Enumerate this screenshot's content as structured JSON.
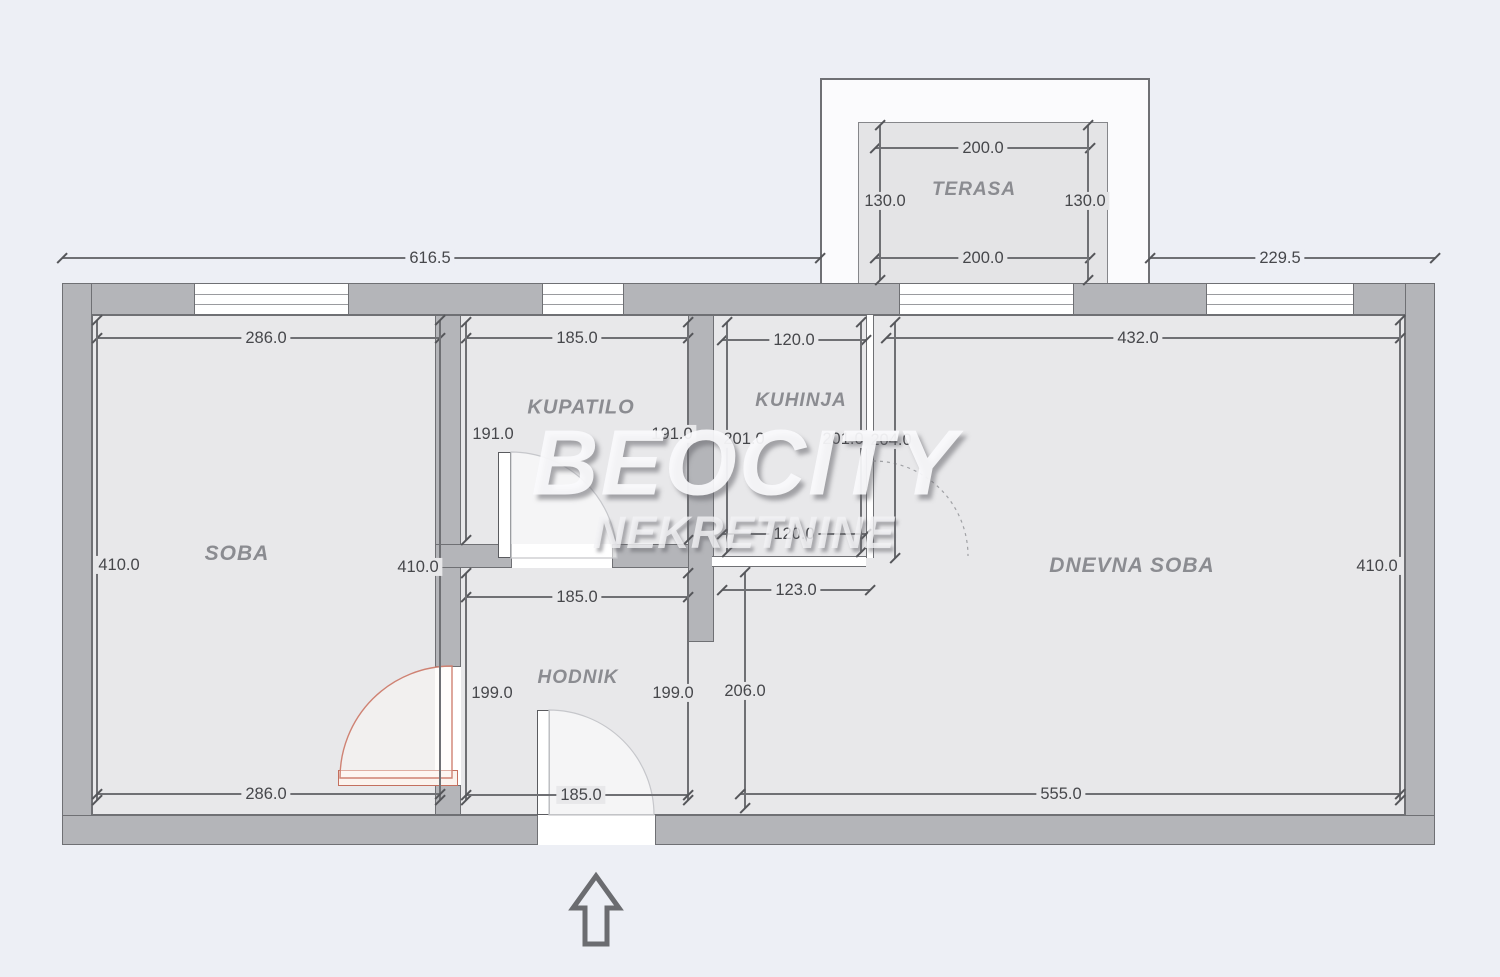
{
  "watermark": {
    "line1": "BEOCITY",
    "line2": "NEKRETNINE"
  },
  "colors": {
    "page": "#edeff5",
    "room": "#e8e8ea",
    "terrace": "#e4e4e6",
    "wall_fill": "#b4b5b9",
    "wall_border": "#6f7074",
    "dim": "#55565a",
    "red_door": "#c4705f",
    "room_label": "#8b8c91"
  },
  "rooms": [
    {
      "name": "SOBA",
      "x": 237,
      "y": 554,
      "size": 21
    },
    {
      "name": "KUPATILO",
      "x": 581,
      "y": 408,
      "size": 20
    },
    {
      "name": "KUHINJA",
      "x": 801,
      "y": 401,
      "size": 19
    },
    {
      "name": "HODNIK",
      "x": 578,
      "y": 678,
      "size": 19
    },
    {
      "name": "DNEVNA SOBA",
      "x": 1132,
      "y": 566,
      "size": 21
    },
    {
      "name": "TERASA",
      "x": 974,
      "y": 190,
      "size": 19
    }
  ],
  "dimensions": [
    {
      "label": "616.5",
      "orient": "h",
      "y": 258,
      "x1": 62,
      "x2": 820,
      "lx": 430,
      "ly": 258,
      "bg": "page"
    },
    {
      "label": "229.5",
      "orient": "h",
      "y": 258,
      "x1": 1150,
      "x2": 1435,
      "lx": 1280,
      "ly": 258,
      "bg": "page"
    },
    {
      "label": "200.0",
      "orient": "h",
      "y": 148,
      "x1": 875,
      "x2": 1090,
      "lx": 983,
      "ly": 148,
      "bg": "terrace"
    },
    {
      "label": "200.0",
      "orient": "h",
      "y": 258,
      "x1": 875,
      "x2": 1090,
      "lx": 983,
      "ly": 258,
      "bg": "terrace"
    },
    {
      "label": "130.0",
      "orient": "v",
      "x": 880,
      "y1": 125,
      "y2": 280,
      "lx": 885,
      "ly": 201,
      "bg": "terrace"
    },
    {
      "label": "130.0",
      "orient": "v",
      "x": 1088,
      "y1": 125,
      "y2": 280,
      "lx": 1085,
      "ly": 201,
      "bg": "terrace"
    },
    {
      "label": "286.0",
      "orient": "h",
      "y": 338,
      "x1": 97,
      "x2": 440,
      "lx": 266,
      "ly": 338,
      "bg": "room"
    },
    {
      "label": "185.0",
      "orient": "h",
      "y": 338,
      "x1": 466,
      "x2": 688,
      "lx": 577,
      "ly": 338,
      "bg": "room"
    },
    {
      "label": "120.0",
      "orient": "h",
      "y": 340,
      "x1": 722,
      "x2": 866,
      "lx": 794,
      "ly": 340,
      "bg": "room"
    },
    {
      "label": "432.0",
      "orient": "h",
      "y": 338,
      "x1": 886,
      "x2": 1400,
      "lx": 1138,
      "ly": 338,
      "bg": "room"
    },
    {
      "label": "410.0",
      "orient": "v",
      "x": 97,
      "y1": 320,
      "y2": 800,
      "lx": 119,
      "ly": 565,
      "bg": "room"
    },
    {
      "label": "410.0",
      "orient": "v",
      "x": 440,
      "y1": 320,
      "y2": 800,
      "lx": 418,
      "ly": 567,
      "bg": "room"
    },
    {
      "label": "191.0",
      "orient": "v",
      "x": 466,
      "y1": 322,
      "y2": 540,
      "lx": 493,
      "ly": 434,
      "bg": "room"
    },
    {
      "label": "191.0",
      "orient": "v",
      "x": 688,
      "y1": 322,
      "y2": 540,
      "lx": 672,
      "ly": 434,
      "bg": "room"
    },
    {
      "label": "201.0",
      "orient": "v",
      "x": 727,
      "y1": 322,
      "y2": 552,
      "lx": 744,
      "ly": 439,
      "bg": "room"
    },
    {
      "label": "201.0",
      "orient": "v",
      "x": 861,
      "y1": 322,
      "y2": 552,
      "lx": 843,
      "ly": 439,
      "bg": "room"
    },
    {
      "label": "204.0",
      "orient": "v",
      "x": 895,
      "y1": 322,
      "y2": 558,
      "lx": 891,
      "ly": 440,
      "bg": "room"
    },
    {
      "label": "410.0",
      "orient": "v",
      "x": 1400,
      "y1": 320,
      "y2": 800,
      "lx": 1377,
      "ly": 566,
      "bg": "room"
    },
    {
      "label": "120.0",
      "orient": "h",
      "y": 534,
      "x1": 722,
      "x2": 866,
      "lx": 794,
      "ly": 534,
      "bg": "room"
    },
    {
      "label": "185.0",
      "orient": "h",
      "y": 597,
      "x1": 466,
      "x2": 688,
      "lx": 577,
      "ly": 597,
      "bg": "room"
    },
    {
      "label": "123.0",
      "orient": "h",
      "y": 590,
      "x1": 722,
      "x2": 870,
      "lx": 796,
      "ly": 590,
      "bg": "room"
    },
    {
      "label": "199.0",
      "orient": "v",
      "x": 466,
      "y1": 573,
      "y2": 800,
      "lx": 492,
      "ly": 693,
      "bg": "room"
    },
    {
      "label": "199.0",
      "orient": "v",
      "x": 688,
      "y1": 573,
      "y2": 800,
      "lx": 673,
      "ly": 693,
      "bg": "room"
    },
    {
      "label": "206.0",
      "orient": "v",
      "x": 745,
      "y1": 572,
      "y2": 808,
      "lx": 745,
      "ly": 691,
      "bg": "room"
    },
    {
      "label": "286.0",
      "orient": "h",
      "y": 794,
      "x1": 97,
      "x2": 440,
      "lx": 266,
      "ly": 794,
      "bg": "room"
    },
    {
      "label": "185.0",
      "orient": "h",
      "y": 795,
      "x1": 466,
      "x2": 688,
      "lx": 581,
      "ly": 795,
      "bg": "room"
    },
    {
      "label": "555.0",
      "orient": "h",
      "y": 794,
      "x1": 740,
      "x2": 1400,
      "lx": 1061,
      "ly": 794,
      "bg": "room"
    }
  ]
}
